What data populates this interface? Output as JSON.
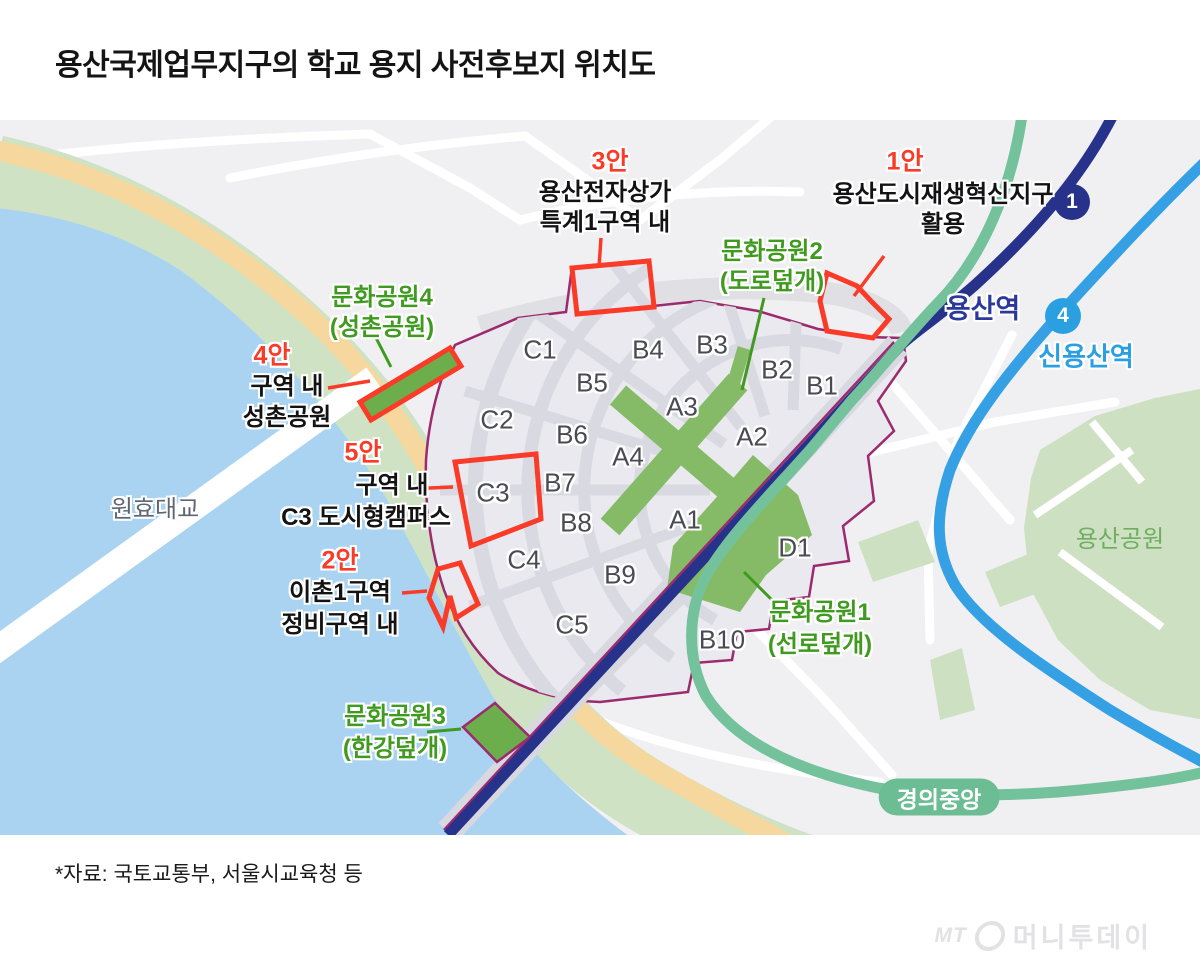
{
  "header": {
    "title": "용산국제업무지구의 학교 용지 사전후보지 위치도"
  },
  "map": {
    "blocks": [
      "C1",
      "B4",
      "B3",
      "B2",
      "B1",
      "B5",
      "A3",
      "C2",
      "B6",
      "A4",
      "A2",
      "B7",
      "C3",
      "B8",
      "A1",
      "C4",
      "B9",
      "D1",
      "C5",
      "B10"
    ],
    "annotations": {
      "plan1": {
        "tag": "1안",
        "line1": "용산도시재생혁신지구",
        "line2": "활용"
      },
      "plan2": {
        "tag": "2안",
        "line1": "이촌1구역",
        "line2": "정비구역 내"
      },
      "plan3": {
        "tag": "3안",
        "line1": "용산전자상가",
        "line2": "특계1구역 내"
      },
      "plan4": {
        "tag": "4안",
        "line1": "구역 내",
        "line2": "성촌공원"
      },
      "plan5": {
        "tag": "5안",
        "line1": "구역 내",
        "line2": "C3 도시형캠퍼스"
      },
      "park1": {
        "line1": "문화공원1",
        "line2": "(선로덮개)"
      },
      "park2": {
        "line1": "문화공원2",
        "line2": "(도로덮개)"
      },
      "park3": {
        "line1": "문화공원3",
        "line2": "(한강덮개)"
      },
      "park4": {
        "line1": "문화공원4",
        "line2": "(성촌공원)"
      }
    },
    "stations": {
      "yongsan": "용산역",
      "sinyongsan": "신용산역",
      "gyeongui_jungang": "경의중앙",
      "line1_badge": "1",
      "line4_badge": "4"
    },
    "places": {
      "bridge": "원효대교",
      "park": "용산공원"
    }
  },
  "colors": {
    "plan_red": "#f93b28",
    "park_green_text": "#3f9a1f",
    "district_boundary": "#9c2a6e",
    "rail_navy": "#27338b",
    "line4_blue": "#36a0e4",
    "gyeongui_teal": "#74c29c",
    "park_fill": "#85bb66",
    "water": "#a9d3f1",
    "shore_orange": "#f6d89e"
  },
  "footer": {
    "source": "*자료: 국토교통부, 서울시교육청 등"
  },
  "watermark": {
    "abbr": "MT",
    "brand": "머니투데이"
  }
}
